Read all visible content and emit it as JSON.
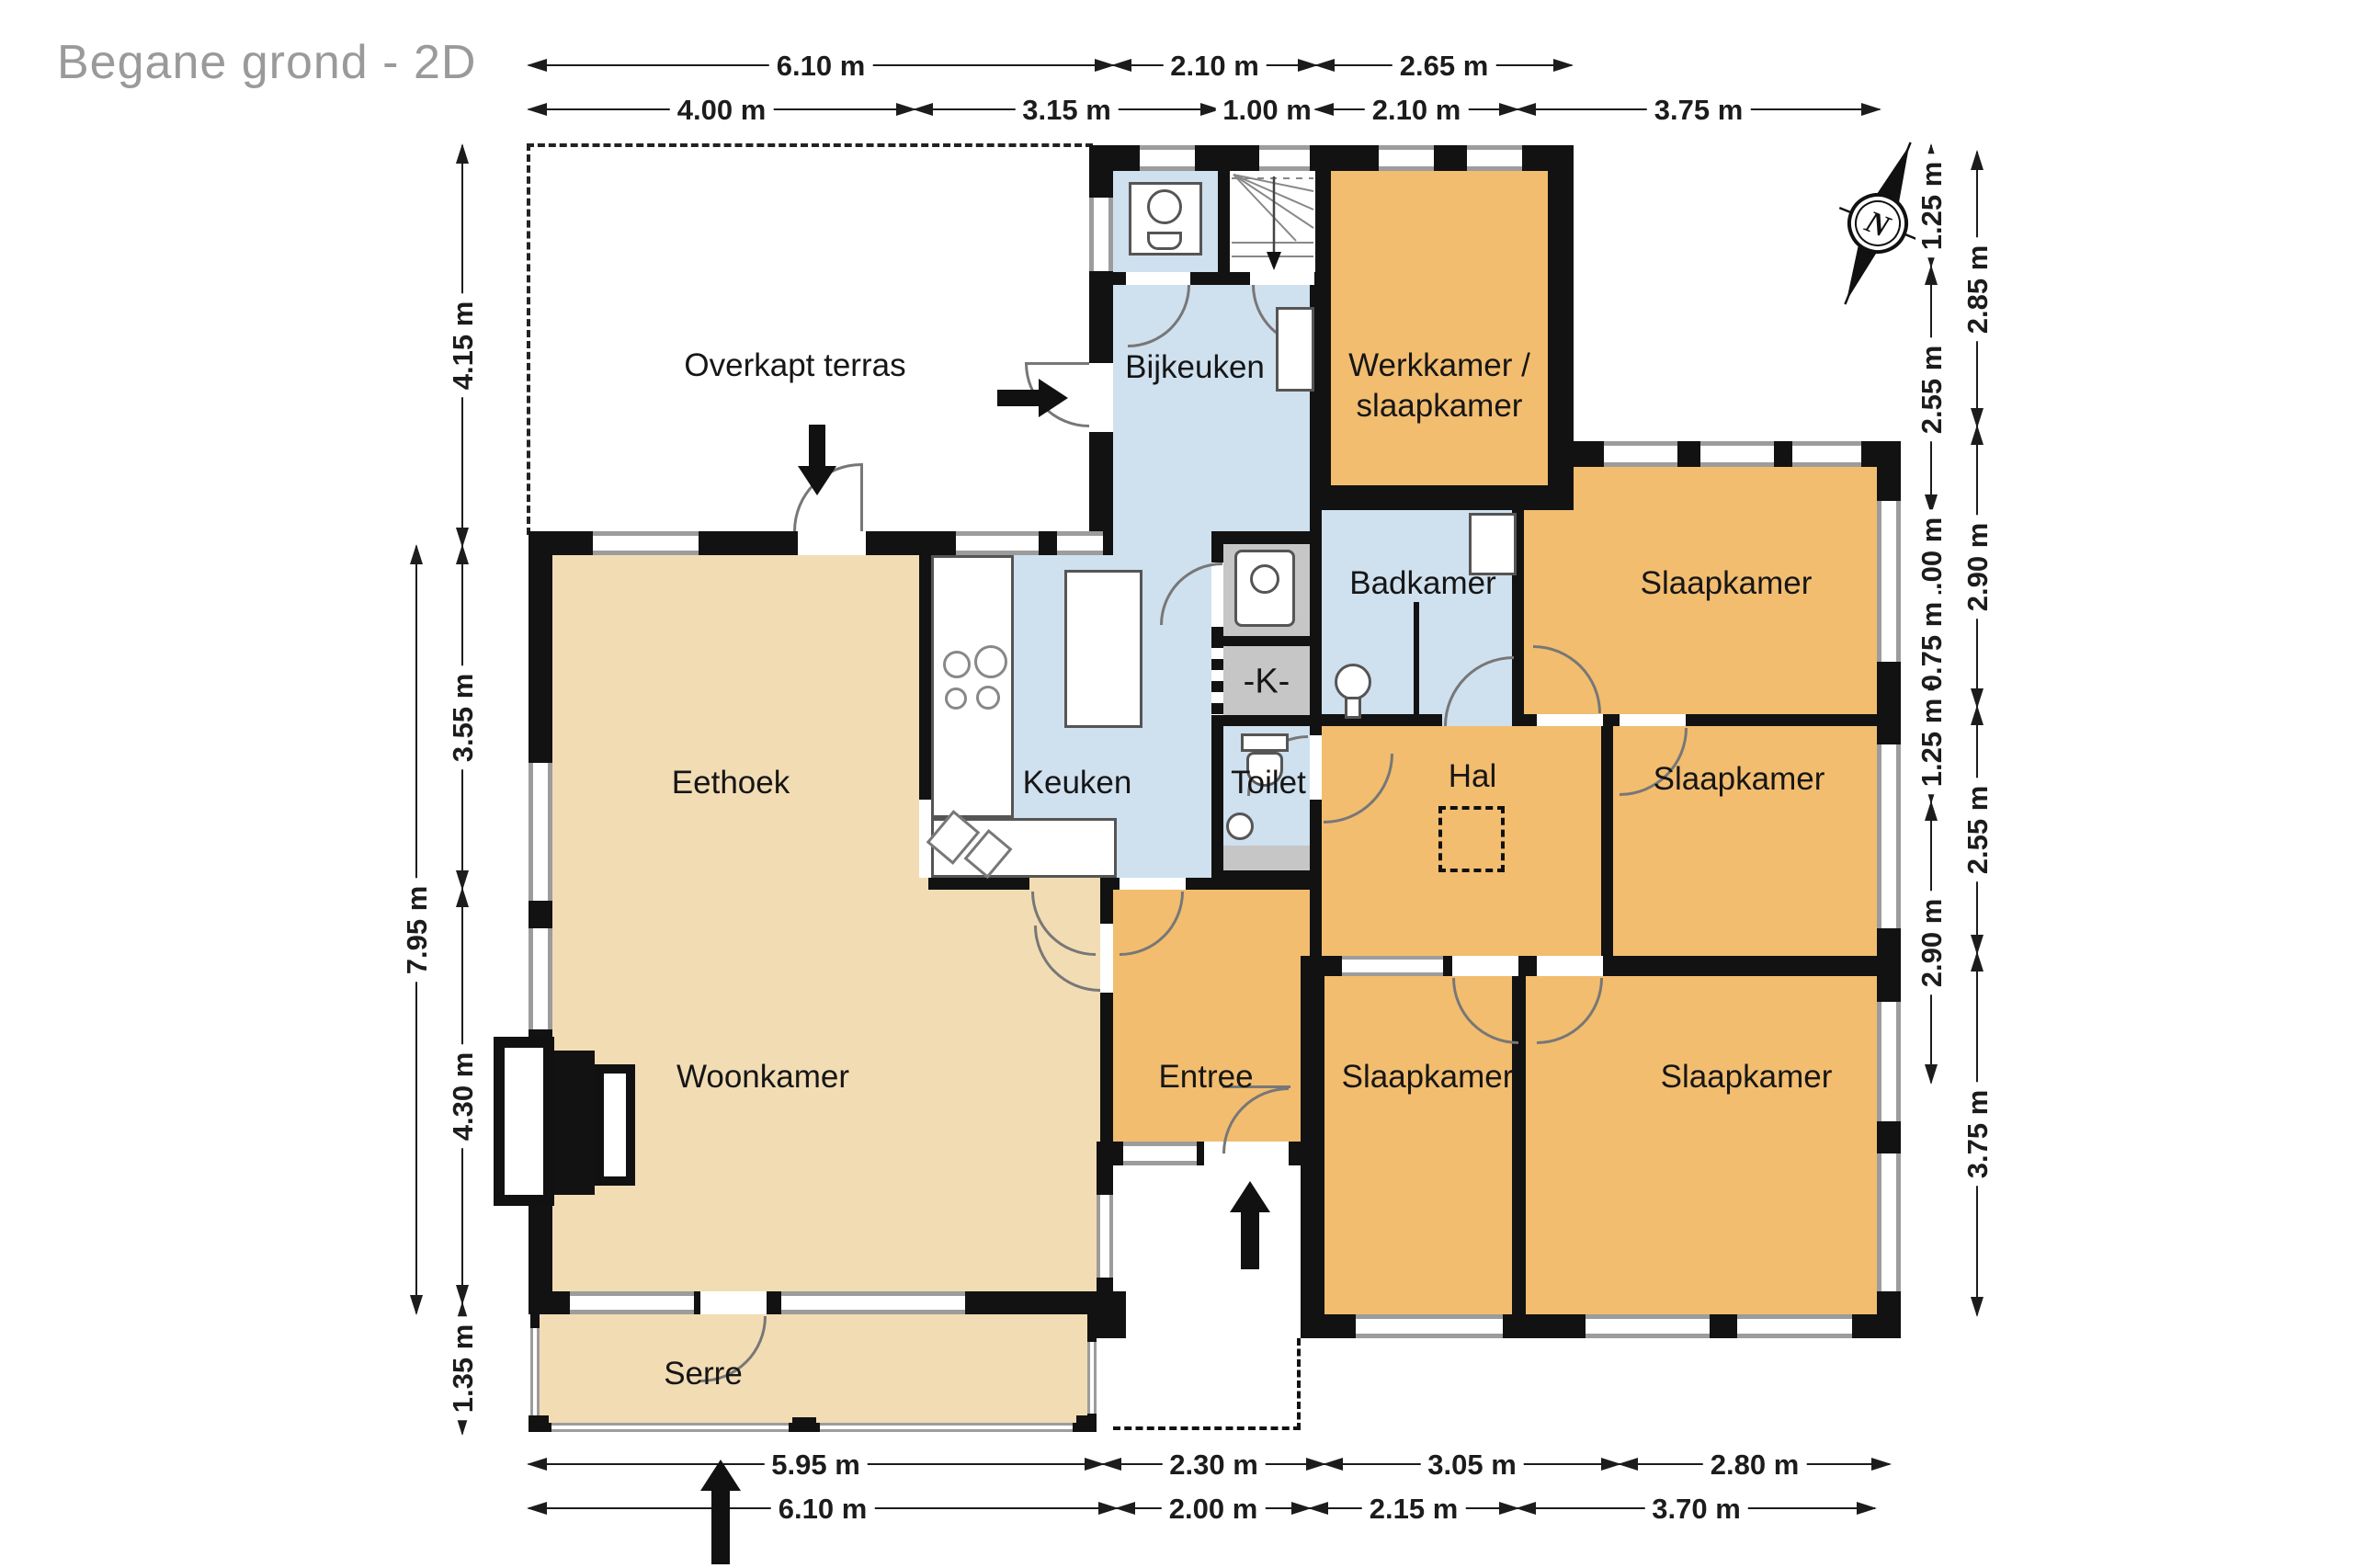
{
  "title": "Begane grond - 2D",
  "compass": {
    "label": "N"
  },
  "rooms": {
    "terras": "Overkapt terras",
    "bijkeuken": "Bijkeuken",
    "werkkamer_line1": "Werkkamer /",
    "werkkamer_line2": "slaapkamer",
    "badkamer": "Badkamer",
    "slaapkamer_tr": "Slaapkamer",
    "slaapkamer_mr": "Slaapkamer",
    "slaapkamer_bm": "Slaapkamer",
    "slaapkamer_br": "Slaapkamer",
    "eethoek": "Eethoek",
    "keuken": "Keuken",
    "kast": "-K-",
    "toilet": "Toilet",
    "hal": "Hal",
    "entree": "Entree",
    "woonkamer": "Woonkamer",
    "serre": "Serre"
  },
  "dims": {
    "top1": [
      "6.10 m",
      "2.10 m",
      "2.65 m"
    ],
    "top2": [
      "4.00 m",
      "3.15 m",
      "1.00 m",
      "2.10 m",
      "3.75 m"
    ],
    "left_inner": [
      "4.15 m",
      "3.55 m",
      "4.30 m",
      "1.35 m"
    ],
    "left_outer": [
      "7.95 m"
    ],
    "right_inner": [
      "1.25 m",
      "2.55 m",
      "1.00 m",
      "0.75 m",
      "1.25 m",
      "2.90 m"
    ],
    "right_outer": [
      "2.85 m",
      "2.90 m",
      "2.55 m",
      "3.75 m"
    ],
    "bottom1": [
      "5.95 m",
      "2.30 m",
      "3.05 m",
      "2.80 m"
    ],
    "bottom2": [
      "6.10 m",
      "2.00 m",
      "2.15 m",
      "3.70 m"
    ]
  },
  "colors": {
    "room_tan": "#f2dcb3",
    "room_orange": "#f2bd6f",
    "room_blue": "#cfe0ef",
    "room_grey": "#c6c6c6",
    "wall": "#121212",
    "title_grey": "#9a9a9a"
  }
}
